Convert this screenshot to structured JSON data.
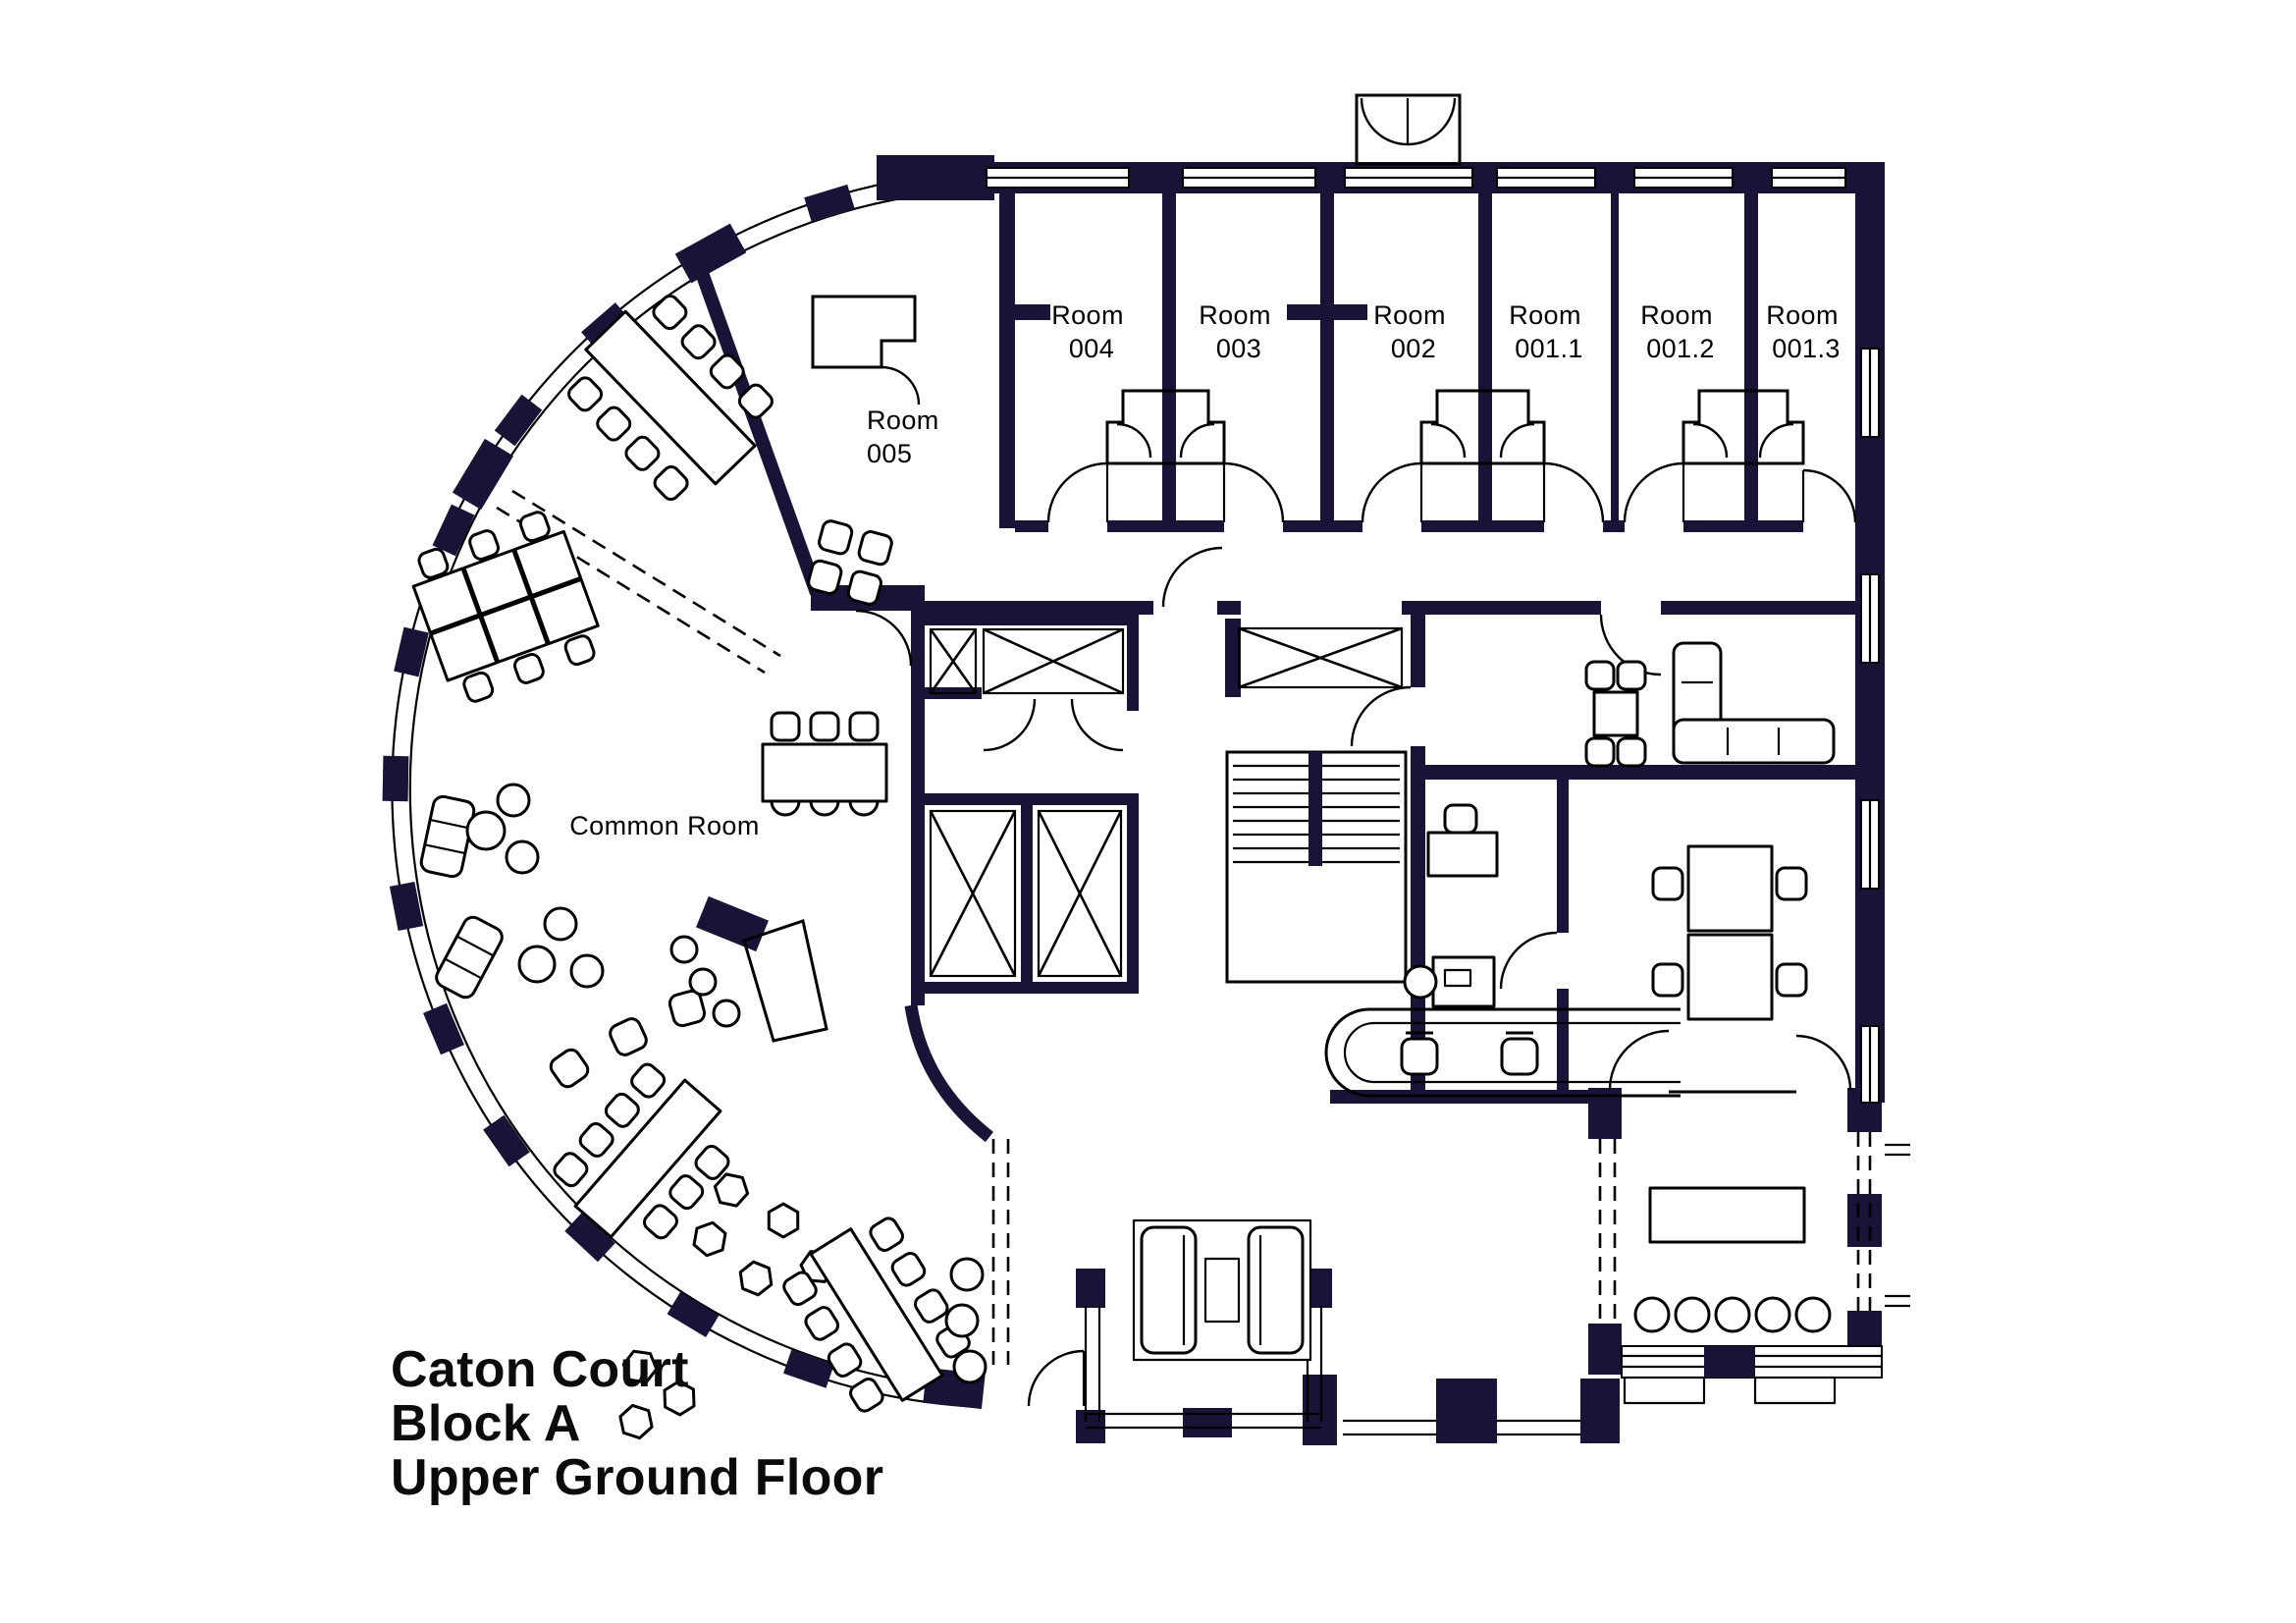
{
  "title": {
    "line1": "Caton Court",
    "line2": "Block A",
    "line3": "Upper Ground Floor"
  },
  "room_labels": {
    "r004": {
      "name": "Room",
      "number": "004"
    },
    "r003": {
      "name": "Room",
      "number": "003"
    },
    "r002": {
      "name": "Room",
      "number": "002"
    },
    "r001_1": {
      "name": "Room",
      "number": "001.1"
    },
    "r001_2": {
      "name": "Room",
      "number": "001.2"
    },
    "r001_3": {
      "name": "Room",
      "number": "001.3"
    },
    "r005": {
      "name": "Room",
      "number": "005"
    }
  },
  "common_room": {
    "label": "Common Room"
  },
  "colors": {
    "wall": "#1b1238",
    "line": "#000000",
    "background": "#ffffff",
    "text": "#000000"
  }
}
